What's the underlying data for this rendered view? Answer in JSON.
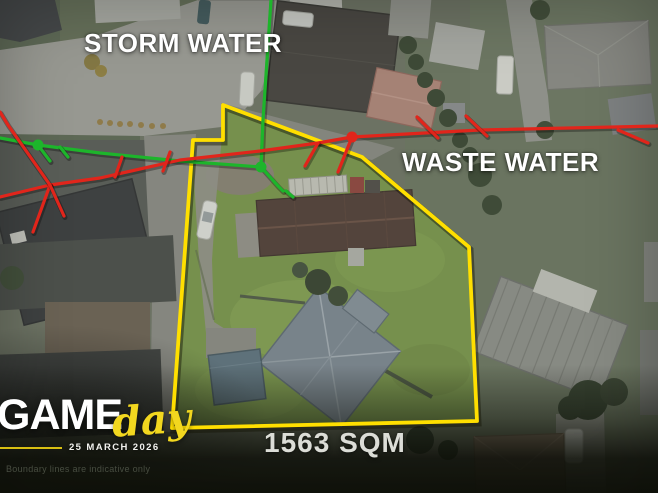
{
  "window": {
    "width": 658,
    "height": 493
  },
  "labels": {
    "storm_water": "STORM WATER",
    "waste_water": "WASTE WATER",
    "area": "1563 SQM",
    "disclaimer": "Boundary lines are indicative only"
  },
  "brand": {
    "name": "GAME",
    "script": "day",
    "date": "25 MARCH 2026"
  },
  "colors": {
    "storm_water_green": "#1db52b",
    "waste_water_red": "#e1251b",
    "boundary_yellow": "#ffdf00",
    "brand_yellow": "#f2d71f"
  },
  "map": {
    "boundary_polygon": [
      [
        223,
        105
      ],
      [
        362,
        157
      ],
      [
        469,
        247
      ],
      [
        477,
        421
      ],
      [
        172,
        428
      ],
      [
        193,
        140
      ],
      [
        223,
        140
      ]
    ],
    "storm": {
      "lines": [
        [
          [
            271,
            0
          ],
          [
            263,
            120
          ],
          [
            261,
            167
          ]
        ],
        [
          [
            0,
            138
          ],
          [
            38,
            145
          ],
          [
            100,
            153
          ],
          [
            180,
            161
          ],
          [
            261,
            167
          ]
        ],
        [
          [
            261,
            167
          ],
          [
            278,
            186
          ],
          [
            283,
            191
          ]
        ],
        [
          [
            38,
            145
          ],
          [
            50,
            161
          ]
        ],
        [
          [
            60,
            147
          ],
          [
            68,
            157
          ]
        ],
        [
          [
            286,
            191
          ],
          [
            293,
            197
          ]
        ]
      ],
      "nodes": [
        [
          38,
          145
        ],
        [
          261,
          167
        ]
      ]
    },
    "waste": {
      "lines": [
        [
          [
            0,
            197
          ],
          [
            50,
            185
          ],
          [
            100,
            178
          ],
          [
            180,
            160
          ],
          [
            260,
            151
          ],
          [
            318,
            143
          ],
          [
            352,
            137
          ],
          [
            480,
            130
          ],
          [
            658,
            126
          ]
        ],
        [
          [
            50,
            185
          ],
          [
            8,
            125
          ],
          [
            0,
            112
          ]
        ],
        [
          [
            50,
            185
          ],
          [
            33,
            232
          ]
        ],
        [
          [
            50,
            185
          ],
          [
            64,
            216
          ]
        ],
        [
          [
            115,
            177
          ],
          [
            122,
            157
          ]
        ],
        [
          [
            163,
            171
          ],
          [
            170,
            152
          ]
        ],
        [
          [
            305,
            166
          ],
          [
            318,
            143
          ]
        ],
        [
          [
            352,
            137
          ],
          [
            338,
            172
          ]
        ],
        [
          [
            438,
            138
          ],
          [
            417,
            117
          ]
        ],
        [
          [
            487,
            136
          ],
          [
            466,
            116
          ]
        ],
        [
          [
            618,
            130
          ],
          [
            648,
            143
          ]
        ]
      ],
      "nodes": [
        [
          352,
          137
        ]
      ]
    }
  }
}
